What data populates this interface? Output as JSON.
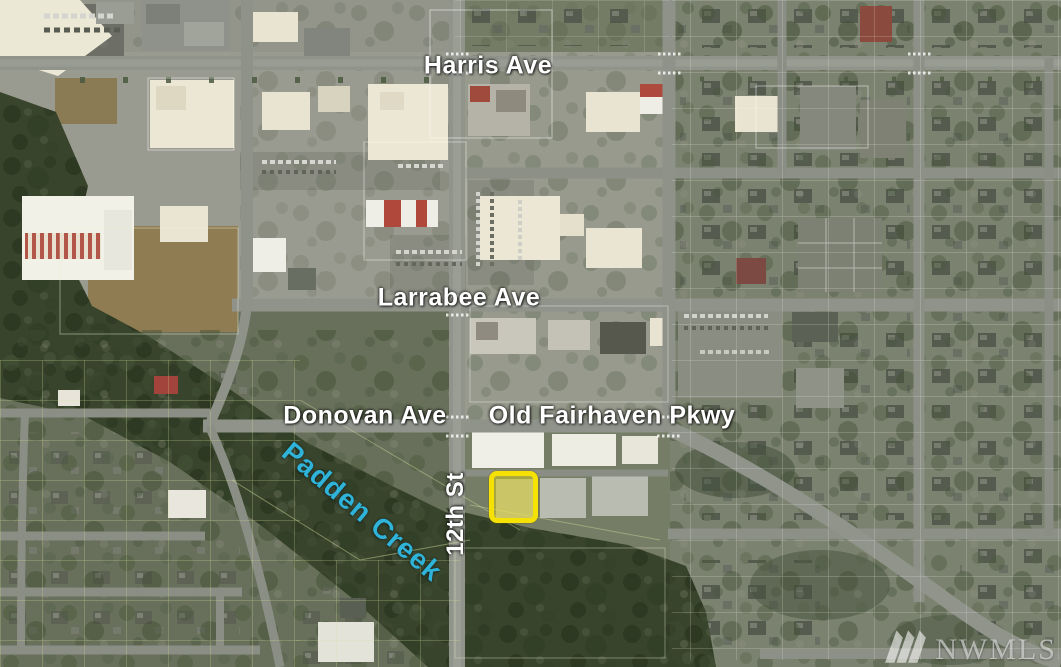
{
  "page_type": "aerial-map-listing-photo",
  "map": {
    "street_labels": {
      "harris_ave": "Harris Ave",
      "larrabee_ave": "Larrabee Ave",
      "donovan_ave": "Donovan Ave",
      "old_fairhaven_pkwy": "Old Fairhaven Pkwy",
      "twelfth_st": "12th St"
    },
    "water_labels": {
      "padden_creek": "Padden Creek"
    },
    "highlight": {
      "border_color": "#f6e104",
      "fill_color": "rgba(246,227,10,0.40)"
    },
    "colors": {
      "street_label_text": "#ffffff",
      "creek_label_text": "#2fb3d9"
    }
  },
  "watermark": {
    "text": "NWMLS",
    "logo": "nwmls-mountains-icon",
    "color": "rgba(255,255,255,0.55)"
  }
}
